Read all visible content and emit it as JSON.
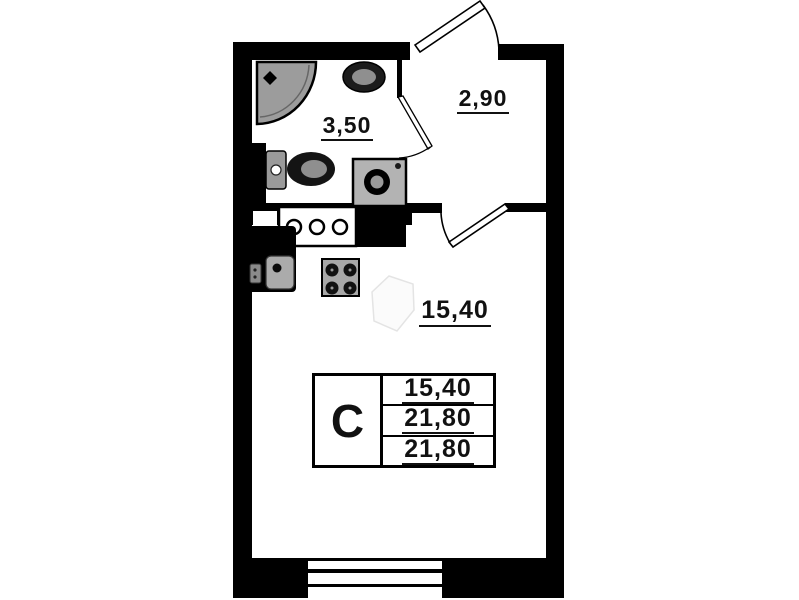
{
  "plan": {
    "title": "studio-apartment-floor-plan",
    "rooms": [
      {
        "id": "bathroom",
        "area": "3,50"
      },
      {
        "id": "hallway",
        "area": "2,90"
      },
      {
        "id": "living-room",
        "area": "15,40"
      }
    ],
    "legend": {
      "type_label": "С",
      "rows": [
        "15,40",
        "21,80",
        "21,80"
      ]
    },
    "colors": {
      "wall": "#000000",
      "fixture_dark": "#141414",
      "fixture_gray": "#a8a8a8",
      "shower_gray": "#9c9c9c",
      "paper": "#ffffff"
    }
  }
}
